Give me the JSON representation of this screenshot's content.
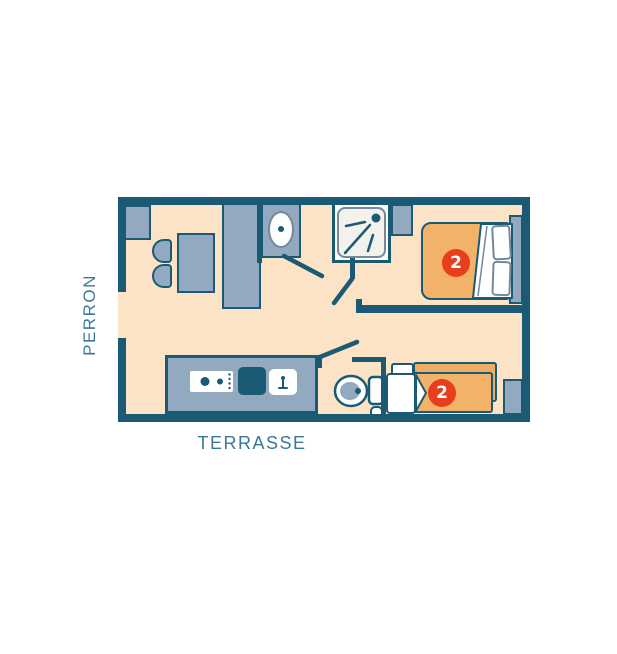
{
  "plan": {
    "labels": {
      "perron": "PERRON",
      "terrasse": "TERRASSE"
    },
    "rooms": {
      "bedroom_double": {
        "capacity_badge": "2"
      },
      "bedroom_twin": {
        "capacity_badge": "2"
      }
    },
    "colors": {
      "wall": "#1b5a74",
      "floor": "#fce3c6",
      "furniture": "#92a9bf",
      "bed_orange": "#f3b269",
      "bed_orange_back": "#edad66",
      "badge_red": "#e73e1d",
      "label_text": "#3a7897",
      "shower_inner": "#f2f1ec",
      "detail_stroke": "#75899b",
      "white": "#ffffff"
    }
  }
}
